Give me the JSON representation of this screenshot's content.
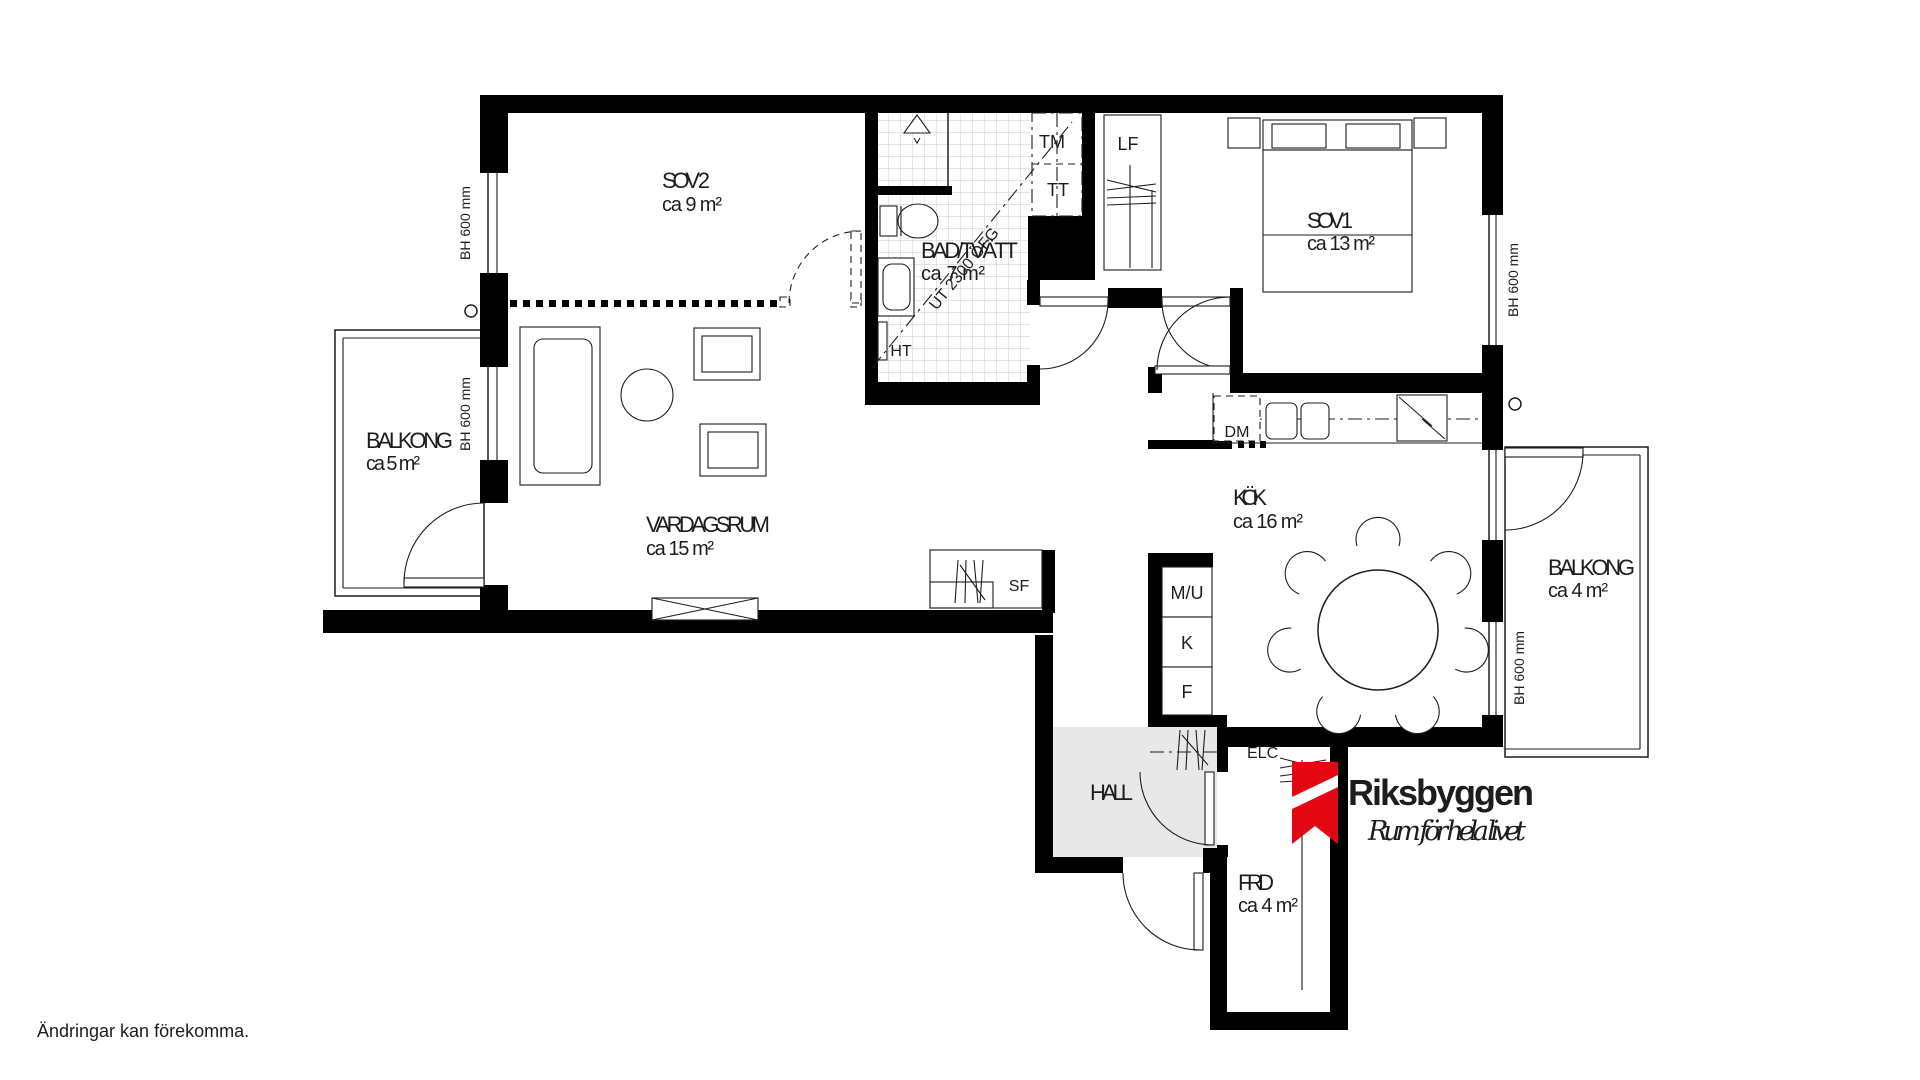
{
  "plan": {
    "rooms": {
      "sov2": {
        "name": "SOV 2",
        "area": "ca 9 m²"
      },
      "bad": {
        "name": "BAD/TVÄTT",
        "area": "ca 7 m²"
      },
      "sov1": {
        "name": "SOV 1",
        "area": "ca 13 m²"
      },
      "vardagsrum": {
        "name": "VARDAGSRUM",
        "area": "ca 15 m²"
      },
      "kok": {
        "name": "KÖK",
        "area": "ca 16 m²"
      },
      "balkong_left": {
        "name": "BALKONG",
        "area": "ca 5 m²"
      },
      "balkong_right": {
        "name": "BALKONG",
        "area": "ca 4 m²"
      },
      "hall": {
        "name": "HALL"
      },
      "frd": {
        "name": "FRD",
        "area": "ca 4 m²"
      }
    },
    "markers": {
      "tm": "TM",
      "tt": "TT",
      "lf": "LF",
      "ht": "HT",
      "dm": "DM",
      "sf": "SF",
      "mu": "M/U",
      "kyl": "K",
      "frys": "F",
      "elc": "ELC",
      "section_line": "UT 2300 ÖFG",
      "window_height": "BH 600 mm"
    }
  },
  "footer": {
    "disclaimer": "Ändringar kan förekomma."
  },
  "logo": {
    "name": "Riksbyggen",
    "tagline": "Rum för hela livet",
    "brand_color": "#e30613"
  }
}
